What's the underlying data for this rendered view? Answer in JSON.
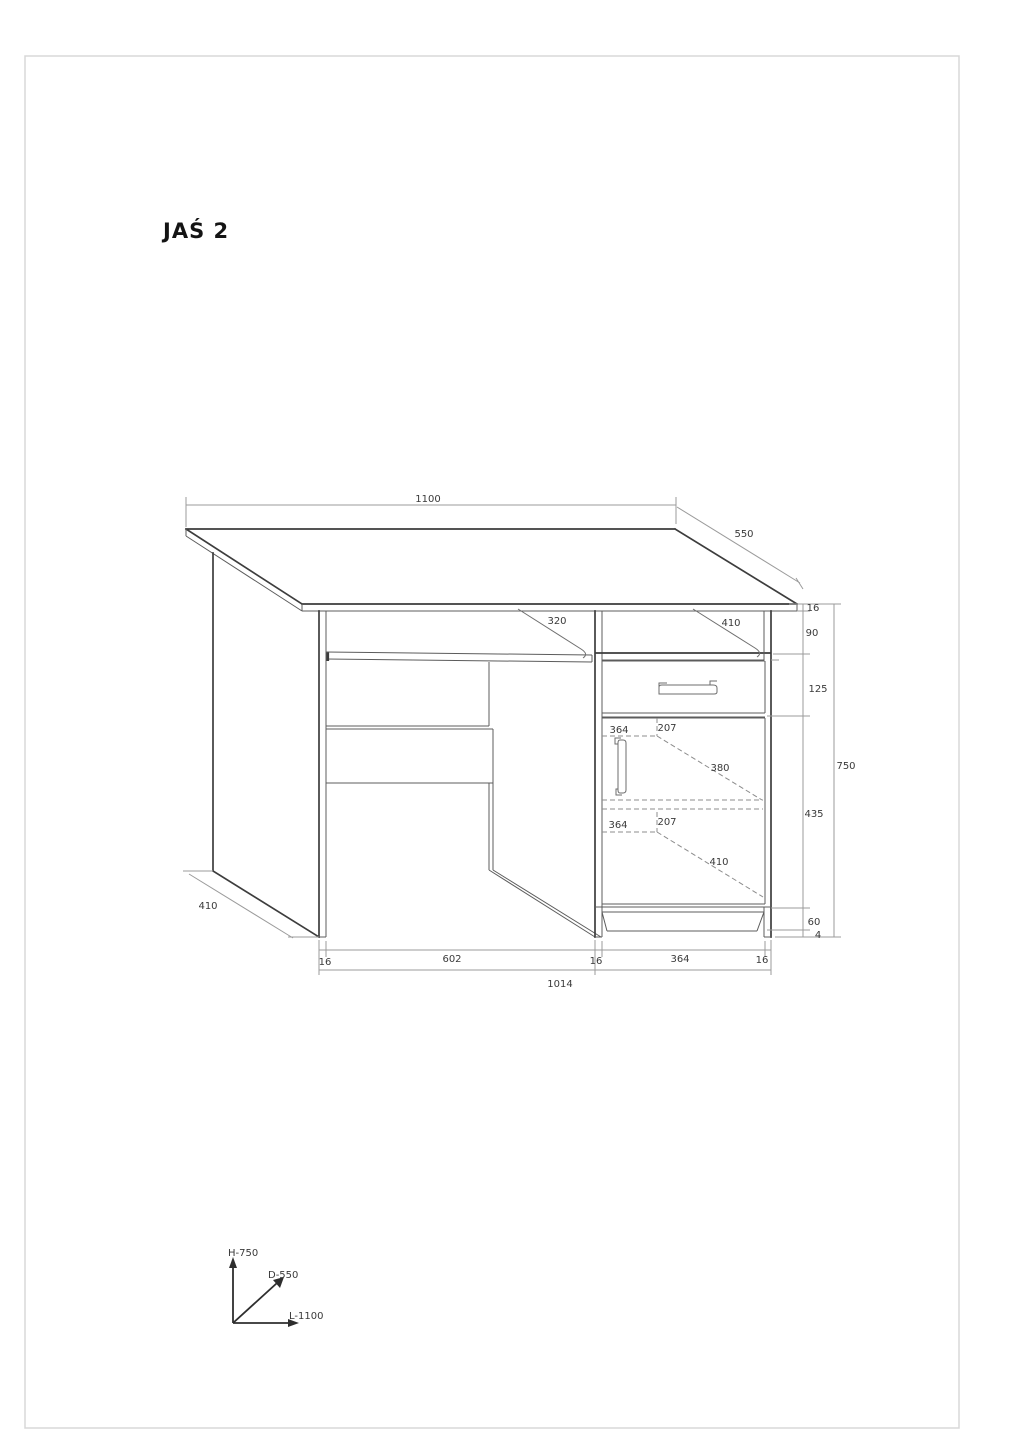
{
  "page": {
    "title": "JAŚ 2"
  },
  "dims": {
    "length_top": "1100",
    "depth_top": "550",
    "top_thickness": "16",
    "under_top_gap": "90",
    "drawer_height": "125",
    "total_height": "750",
    "door_height": "435",
    "plinth_height": "60",
    "floor_clearance": "4",
    "keyboard_shelf_depth": "320",
    "cabinet_top_depth": "410",
    "door_inner_width_upper": "364",
    "door_inner_gap_upper": "207",
    "door_shelf_depth": "380",
    "door_inner_width_lower": "364",
    "door_inner_gap_lower": "207",
    "door_bottom_depth": "410",
    "side_panel_depth": "410",
    "base_left_thickness": "16",
    "base_left_opening": "602",
    "base_mid_thickness": "16",
    "base_cabinet_width": "364",
    "base_right_thickness": "16",
    "base_total": "1014"
  },
  "axis_legend": {
    "height": "H-750",
    "depth": "D-550",
    "length": "L-1100"
  }
}
